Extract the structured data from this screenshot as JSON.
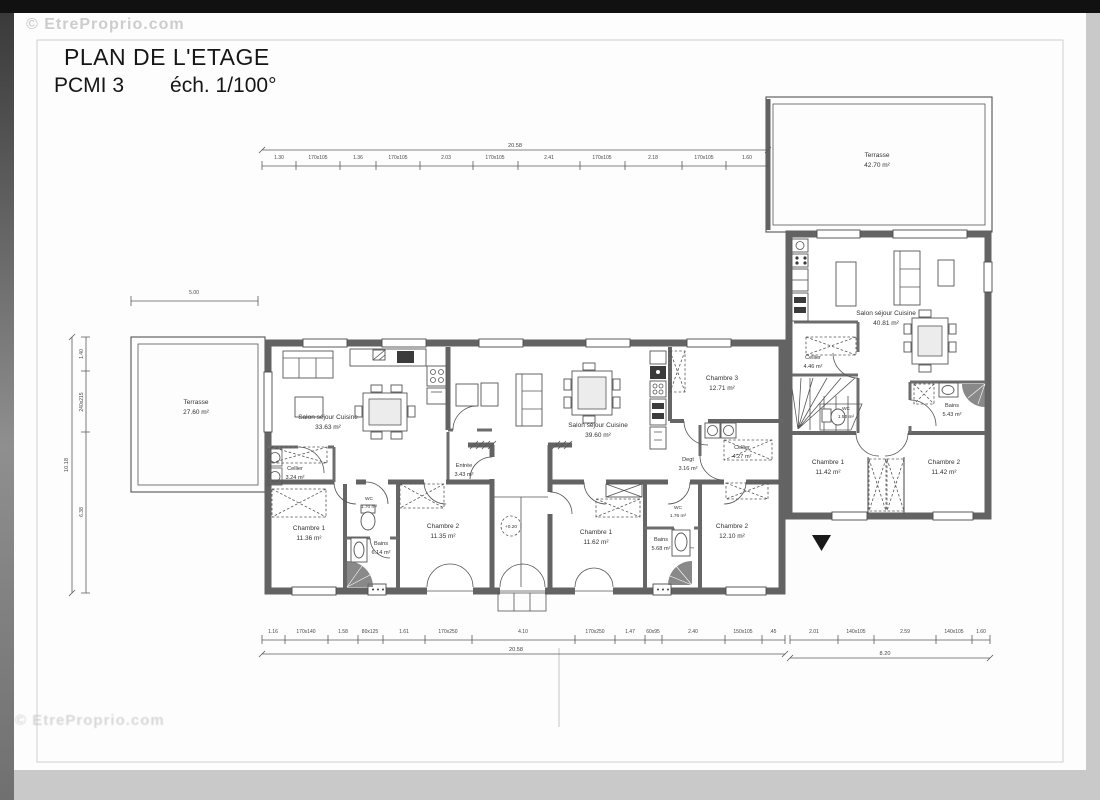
{
  "watermarks": {
    "top": "© EtreProprio.com",
    "bottom": "© EtreProprio.com"
  },
  "title": {
    "line1": "PLAN DE L'ETAGE",
    "pcmi": "PCMI 3",
    "scale": "éch. 1/100°"
  },
  "level_marker": "+0.20",
  "rooms": {
    "terrasse_tr": {
      "name": "Terrasse",
      "area": "42.70 m²"
    },
    "salon_right": {
      "name": "Salon séjour Cuisine",
      "area": "40.81 m²"
    },
    "cellier_right": {
      "name": "Cellier",
      "area": "4.46 m²"
    },
    "wc_right": {
      "name": "WC",
      "area": "1.50 m²"
    },
    "bains_right": {
      "name": "Bains",
      "area": "5.43 m²"
    },
    "ch1_right": {
      "name": "Chambre 1",
      "area": "11.42 m²"
    },
    "ch2_right": {
      "name": "Chambre 2",
      "area": "11.42 m²"
    },
    "terrasse_left": {
      "name": "Terrasse",
      "area": "27.60 m²"
    },
    "salon_left": {
      "name": "Salon séjour Cuisine",
      "area": "33.63 m²"
    },
    "cellier_left": {
      "name": "Cellier",
      "area": "3.24 m²"
    },
    "entree_left": {
      "name": "Entrée",
      "area": "3.43 m²"
    },
    "ch1_left": {
      "name": "Chambre 1",
      "area": "11.36 m²"
    },
    "wc_left": {
      "name": "WC",
      "area": "1.70 m²"
    },
    "bains_left": {
      "name": "Bains",
      "area": "6.14 m²"
    },
    "ch2_left": {
      "name": "Chambre 2",
      "area": "11.35 m²"
    },
    "salon_mid": {
      "name": "Salon séjour Cuisine",
      "area": "39.60 m²"
    },
    "ch3_mid": {
      "name": "Chambre 3",
      "area": "12.71 m²"
    },
    "cellier_mid": {
      "name": "Cellier",
      "area": "4.27 m²"
    },
    "degt_mid": {
      "name": "Degt",
      "area": "3.16 m²"
    },
    "ch1_mid": {
      "name": "Chambre 1",
      "area": "11.62 m²"
    },
    "wc_mid": {
      "name": "WC",
      "area": "1.76 m²"
    },
    "bains_mid": {
      "name": "Bains",
      "area": "5.68 m²"
    },
    "ch2_mid": {
      "name": "Chambre 2",
      "area": "12.10 m²"
    }
  },
  "dims": {
    "top_total": "20.58",
    "top_segments": [
      "1.30",
      "170x105",
      "1.36",
      "170x105",
      "2.03",
      "170x105",
      "2.41",
      "170x105",
      "2.18",
      "170x105",
      "1.60"
    ],
    "terrace_width": "5.00",
    "left_total": "10.18",
    "left_segments": [
      "1.40",
      "240x215",
      "6.38"
    ],
    "bottom_total": "20.58",
    "bottom_segments": [
      "1.16",
      "170x140",
      "1.58",
      "80x125",
      "1.61",
      "170x250",
      "4.10",
      "170x250",
      "1.47",
      "60x95",
      "2.40",
      "150x105",
      ".45"
    ],
    "right_total": "8.20",
    "right_segments": [
      "2.01",
      "140x105",
      "2.59",
      "140x105",
      "1.60"
    ]
  }
}
